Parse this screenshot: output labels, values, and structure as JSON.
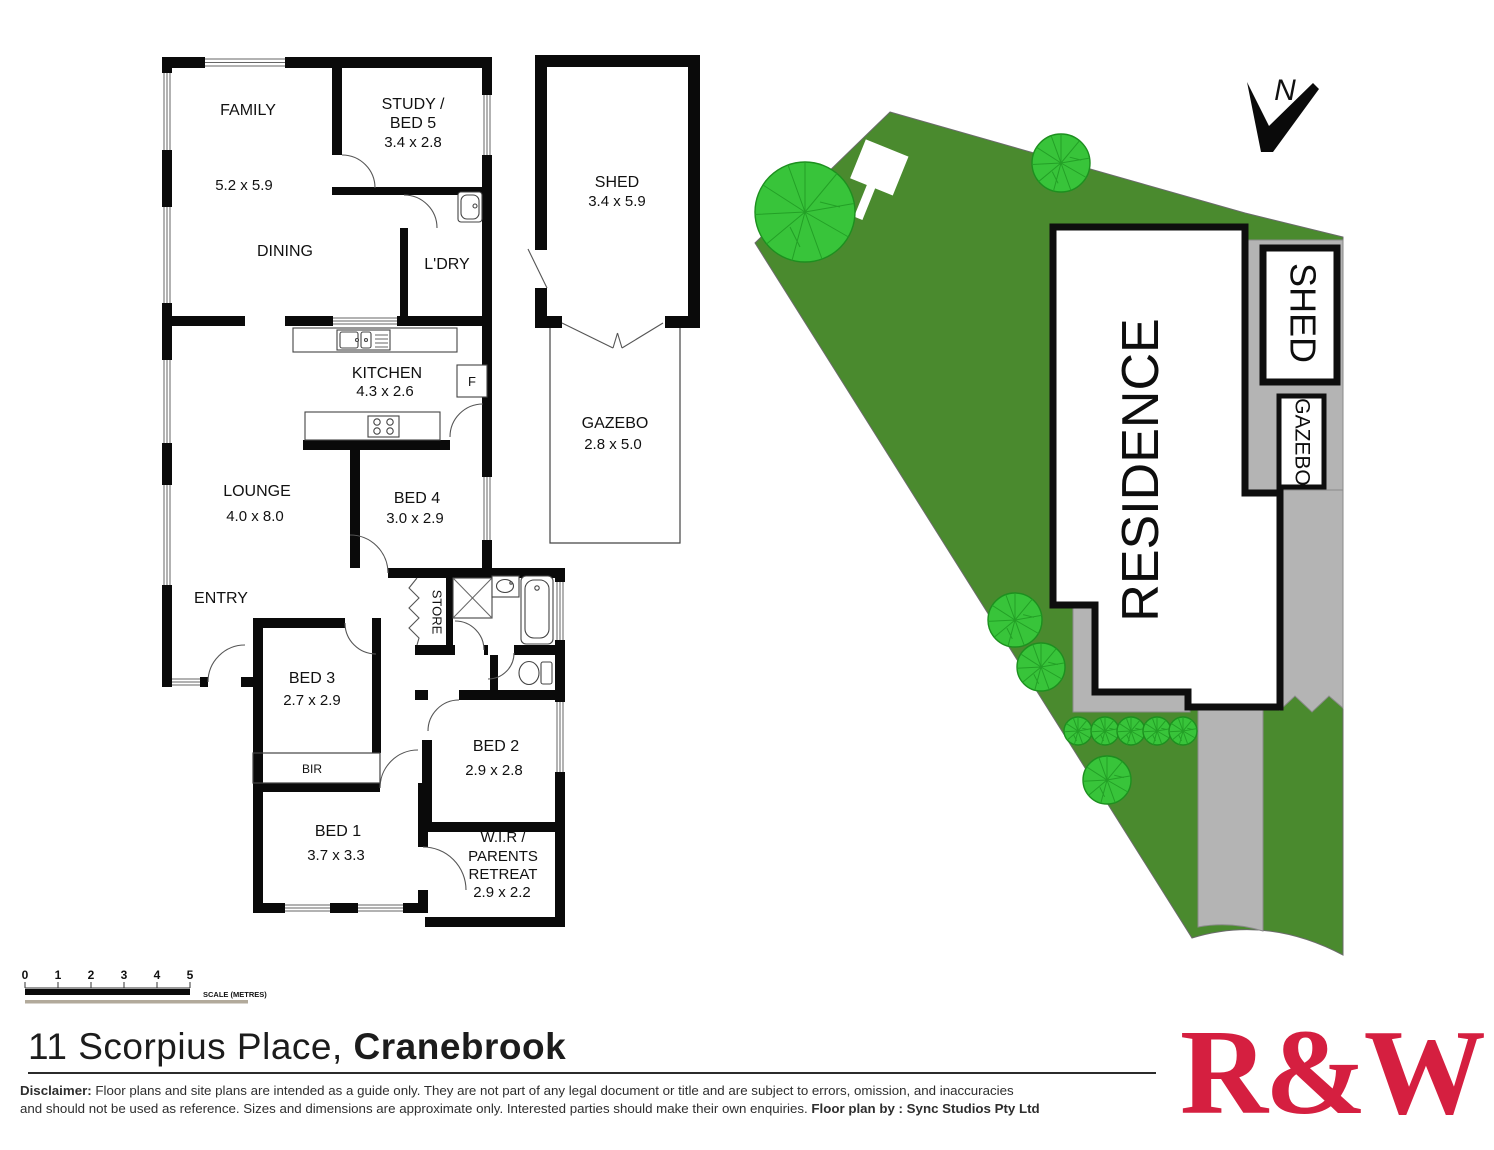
{
  "floor_plan": {
    "rooms": {
      "family": {
        "label": "FAMILY",
        "dims": "5.2 x 5.9"
      },
      "dining": {
        "label": "DINING"
      },
      "study": {
        "label_line1": "STUDY /",
        "label_line2": "BED 5",
        "dims": "3.4 x 2.8"
      },
      "laundry": {
        "label": "L'DRY"
      },
      "shed": {
        "label": "SHED",
        "dims": "3.4 x 5.9"
      },
      "gazebo": {
        "label": "GAZEBO",
        "dims": "2.8 x 5.0"
      },
      "kitchen": {
        "label": "KITCHEN",
        "dims": "4.3 x 2.6"
      },
      "fridge": {
        "label": "F"
      },
      "lounge": {
        "label": "LOUNGE",
        "dims": "4.0 x 8.0"
      },
      "bed4": {
        "label": "BED 4",
        "dims": "3.0 x 2.9"
      },
      "entry": {
        "label": "ENTRY"
      },
      "store": {
        "label": "STORE"
      },
      "bed3": {
        "label": "BED 3",
        "dims": "2.7 x 2.9"
      },
      "bir": {
        "label": "BIR"
      },
      "bed2": {
        "label": "BED 2",
        "dims": "2.9 x 2.8"
      },
      "bed1": {
        "label": "BED 1",
        "dims": "3.7 x 3.3"
      },
      "wir": {
        "label_line1": "W.I.R /",
        "label_line2": "PARENTS",
        "label_line3": "RETREAT",
        "dims": "2.9 x 2.2"
      }
    }
  },
  "site_plan": {
    "residence_label": "RESIDENCE",
    "shed_label": "SHED",
    "gazebo_label": "GAZEBO",
    "north_label": "N"
  },
  "scale_bar": {
    "ticks": [
      "0",
      "1",
      "2",
      "3",
      "4",
      "5"
    ],
    "caption": "SCALE (METRES)"
  },
  "title": {
    "address_line": "11 Scorpius Place, ",
    "suburb_bold": "Cranebrook"
  },
  "disclaimer": {
    "label": "Disclaimer:",
    "line1": " Floor plans and site plans are intended as a guide only. They are not part of any legal document or title and are subject to errors, omission, and inaccuracies",
    "line2": "and should not be used as reference. Sizes and dimensions are approximate only. Interested parties should make their own enquiries. ",
    "credit_bold": "Floor plan by : Sync Studios Pty Ltd"
  },
  "logo": {
    "text": "R&W",
    "color": "#d51f40"
  },
  "colors": {
    "grass": "#4a8a2e",
    "tree": "#38c43a",
    "path": "#b4b4b4",
    "wall": "#0a0a0a",
    "window_line": "#666666",
    "logo_red": "#d51f40"
  }
}
